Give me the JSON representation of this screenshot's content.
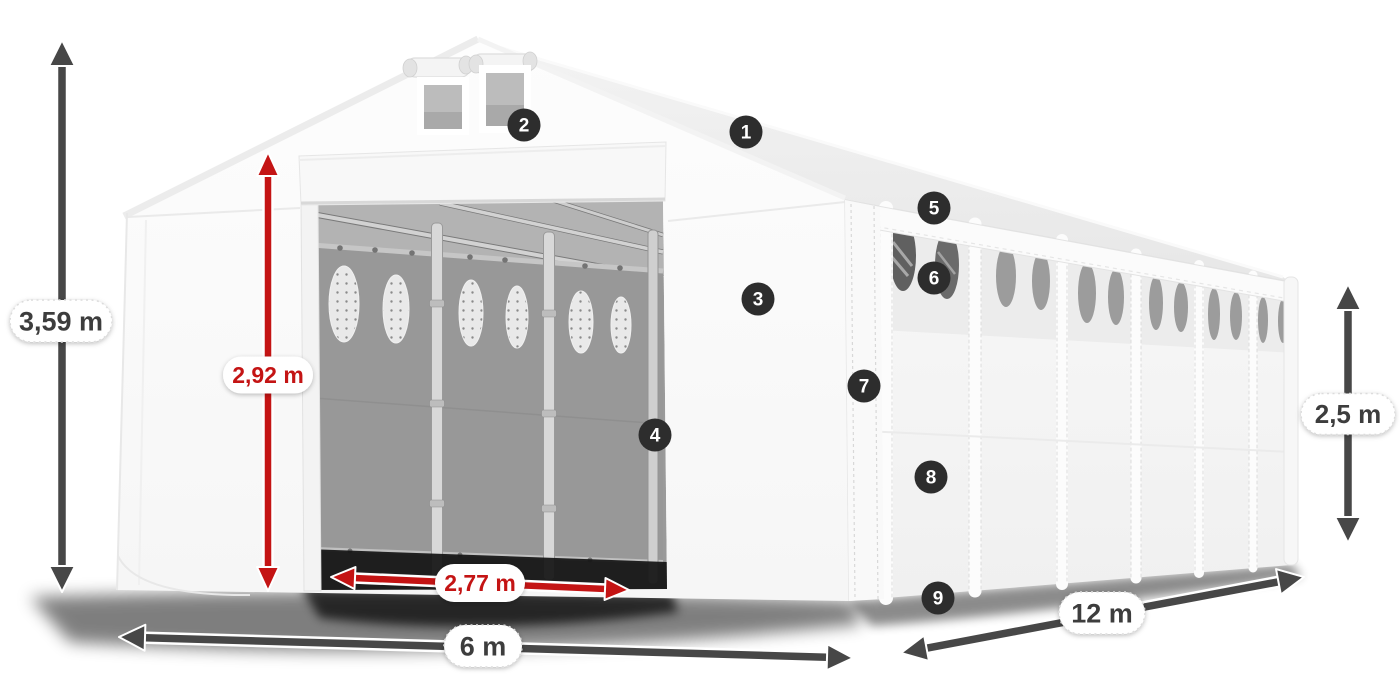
{
  "colors": {
    "background": "#ffffff",
    "dimension_dark": "#474747",
    "dimension_red": "#c41414",
    "label_text_dark": "#3d3d3d",
    "label_text_red": "#c41414",
    "pill_bg": "#ffffff",
    "pill_border": "#dcdcdc",
    "badge_bg": "#2d2d2d",
    "badge_text": "#ffffff"
  },
  "dimensions": [
    {
      "id": "total-height",
      "label": "3,59 m",
      "style": "dark",
      "x1": 62,
      "y1": 40,
      "x2": 62,
      "y2": 592,
      "lx": 61,
      "ly": 321,
      "pw": 102,
      "ph": 42,
      "fs": 27
    },
    {
      "id": "front-width",
      "label": "6 m",
      "style": "dark",
      "x1": 119,
      "y1": 637,
      "x2": 853,
      "y2": 658,
      "lx": 483,
      "ly": 646,
      "pw": 78,
      "ph": 42,
      "fs": 27
    },
    {
      "id": "side-length",
      "label": "12 m",
      "style": "dark",
      "x1": 901,
      "y1": 653,
      "x2": 1304,
      "y2": 577,
      "lx": 1102,
      "ly": 613,
      "pw": 86,
      "ph": 42,
      "fs": 27
    },
    {
      "id": "side-height",
      "label": "2,5 m",
      "style": "dark",
      "x1": 1348,
      "y1": 284,
      "x2": 1348,
      "y2": 543,
      "lx": 1348,
      "ly": 414,
      "pw": 94,
      "ph": 41,
      "fs": 26
    },
    {
      "id": "door-height",
      "label": "2,92 m",
      "style": "red",
      "x1": 268,
      "y1": 152,
      "x2": 268,
      "y2": 591,
      "lx": 268,
      "ly": 375,
      "pw": 90,
      "ph": 37,
      "fs": 23
    },
    {
      "id": "door-width",
      "label": "2,77 m",
      "style": "red",
      "x1": 331,
      "y1": 577,
      "x2": 629,
      "y2": 590,
      "lx": 480,
      "ly": 583,
      "pw": 90,
      "ph": 38,
      "fs": 23
    }
  ],
  "markers": [
    {
      "number": "1",
      "x": 746,
      "y": 132
    },
    {
      "number": "2",
      "x": 524,
      "y": 125
    },
    {
      "number": "3",
      "x": 758,
      "y": 299
    },
    {
      "number": "4",
      "x": 655,
      "y": 435
    },
    {
      "number": "5",
      "x": 934,
      "y": 208
    },
    {
      "number": "6",
      "x": 934,
      "y": 278
    },
    {
      "number": "7",
      "x": 864,
      "y": 386
    },
    {
      "number": "8",
      "x": 931,
      "y": 477
    },
    {
      "number": "9",
      "x": 938,
      "y": 598
    }
  ]
}
